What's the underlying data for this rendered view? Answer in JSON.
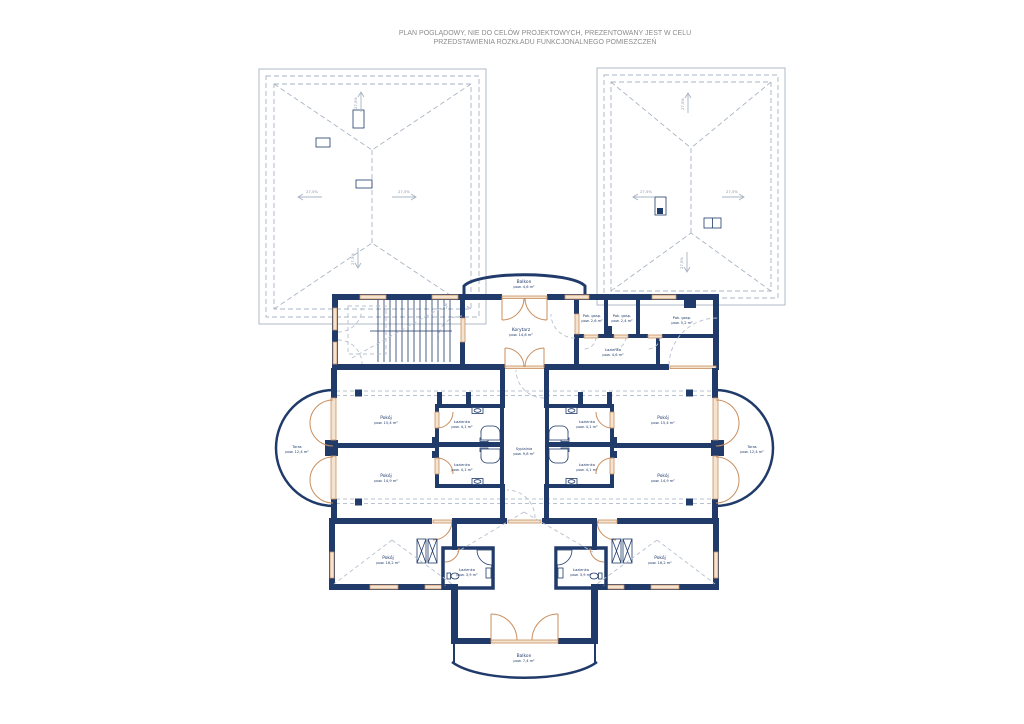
{
  "header": {
    "line1": "PLAN POGLĄDOWY, NIE DO CELÓW PROJEKTOWYCH, PREZENTOWANY JEST W CELU",
    "line2": "PRZEDSTAWIENIA ROZKŁADU FUNKCJONALNEGO POMIESZCZEŃ"
  },
  "colors": {
    "wall": "#203a6a",
    "roof_line": "#a9b4c3",
    "dashed_line": "#b8c1cf",
    "door": "#c98f5f",
    "door_fill": "#f3e3cf",
    "header_text": "#8c8c8c",
    "slope_text": "#8794a8",
    "background": "#ffffff"
  },
  "roof": {
    "slope_label": "27,5%"
  },
  "rooms": {
    "balkon_gorny": {
      "name": "Balkon",
      "area": "pow. 4,6 m²"
    },
    "korytarz": {
      "name": "Korytarz",
      "area": "pow. 14,8 m²"
    },
    "pok_gosp_1": {
      "name": "Pok. gosp.",
      "area": "pow. 2,6 m²"
    },
    "pok_gosp_2": {
      "name": "Pok. gosp.",
      "area": "pow. 2,4 m²"
    },
    "pok_gosp_3": {
      "name": "Pok. gosp.",
      "area": "pow. 5,2 m²"
    },
    "lazienka_gorna": {
      "name": "Łazienka",
      "area": "pow. 4,6 m²"
    },
    "pokoj_1": {
      "name": "Pokój",
      "area": "pow. 15,4 m²"
    },
    "pokoj_2": {
      "name": "Pokój",
      "area": "pow. 14,9 m²"
    },
    "pokoj_3": {
      "name": "Pokój",
      "area": "pow. 15,4 m²"
    },
    "pokoj_4": {
      "name": "Pokój",
      "area": "pow. 14,9 m²"
    },
    "lazienka_1": {
      "name": "Łazienka",
      "area": "pow. 4,1 m²"
    },
    "lazienka_2": {
      "name": "Łazienka",
      "area": "pow. 4,1 m²"
    },
    "lazienka_3": {
      "name": "Łazienka",
      "area": "pow. 4,1 m²"
    },
    "lazienka_4": {
      "name": "Łazienka",
      "area": "pow. 4,1 m²"
    },
    "sypialnia": {
      "name": "Sypialnia",
      "area": "pow. 9,8 m²"
    },
    "taras_lewy": {
      "name": "Taras",
      "area": "pow. 12,4 m²"
    },
    "taras_prawy": {
      "name": "Taras",
      "area": "pow. 12,4 m²"
    },
    "pokoj_5": {
      "name": "Pokój",
      "area": "pow. 16,2 m²"
    },
    "pokoj_6": {
      "name": "Pokój",
      "area": "pow. 16,2 m²"
    },
    "lazienka_5": {
      "name": "Łazienka",
      "area": "pow. 3,9 m²"
    },
    "lazienka_6": {
      "name": "Łazienka",
      "area": "pow. 3,9 m²"
    },
    "balkon_dolny": {
      "name": "Balkon",
      "area": "pow. 7,4 m²"
    }
  }
}
